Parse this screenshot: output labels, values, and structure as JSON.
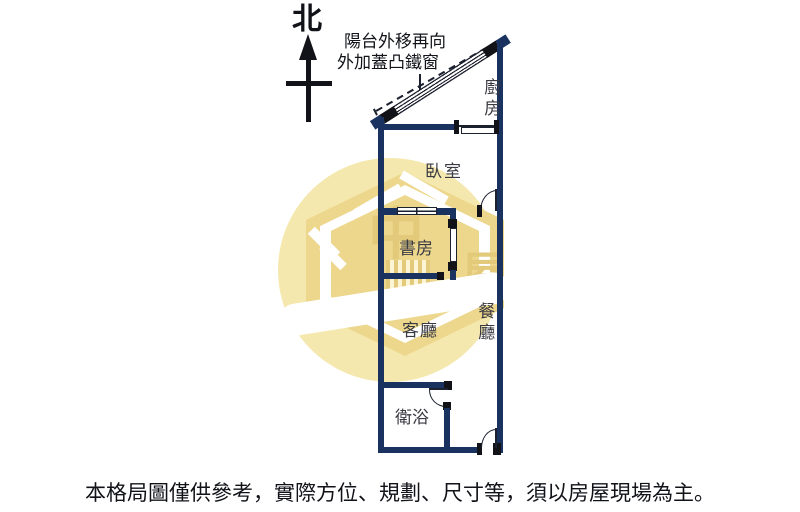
{
  "compass": {
    "label": "北"
  },
  "annotation": {
    "line1": "陽台外移再向",
    "line2": "外加蓋凸鐵窗"
  },
  "rooms": {
    "kitchen": "廚房",
    "bedroom": "臥室",
    "study": "書房",
    "living": "客廳",
    "dining": "餐廳",
    "bathroom": "衛浴"
  },
  "watermark": {
    "char_left": "中",
    "char_right": "屋"
  },
  "disclaimer": "本格局圖僅供參考，實際方位、規劃、尺寸等，須以房屋現場為主。",
  "colors": {
    "wall": "#1a3260",
    "ink": "#111318",
    "line": "#1c2130",
    "label": "#3a3a42",
    "watermark_light": "#f5e8ae",
    "watermark_mid": "#ecd78d",
    "watermark_dark": "#e3ca7b"
  }
}
